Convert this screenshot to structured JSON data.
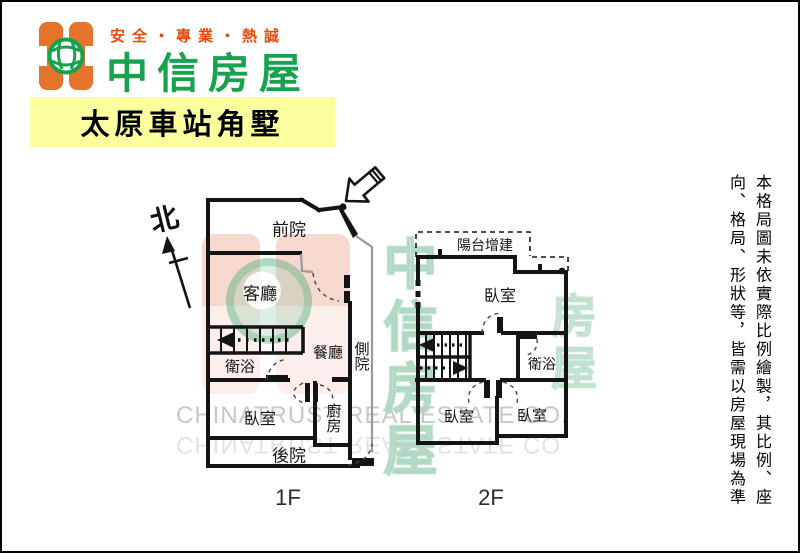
{
  "header": {
    "slogan": "安全・專業・熱誠",
    "brand": "中信房屋",
    "listing_title": "太原車站角墅",
    "colors": {
      "brand_orange": "#e5732a",
      "brand_green": "#17a24e",
      "slogan_red": "#e84a10",
      "banner_yellow": "#fbff9e"
    }
  },
  "floorplan": {
    "north_label": "北",
    "floor1": {
      "floor_label": "1F",
      "rooms": {
        "front_yard": "前院",
        "living_room": "客廳",
        "dining_room": "餐廳",
        "side_yard": "側院",
        "bathroom": "衛浴",
        "bedroom": "臥室",
        "kitchen": "廚房",
        "back_yard": "後院"
      }
    },
    "floor2": {
      "floor_label": "2F",
      "rooms": {
        "balcony_addition": "陽台增建",
        "bedroom_top": "臥室",
        "bathroom": "衛浴",
        "bedroom_bottom_left": "臥室",
        "bedroom_bottom_right": "臥室"
      }
    }
  },
  "watermark": {
    "latin_line": "CHINATRUST REAL ESTATE CO.",
    "cjk_column_main": "中信房屋",
    "cjk_column_secondary": "房屋"
  },
  "disclaimer": {
    "column_1": "本格局圖未依實際比例繪製，其比例、座",
    "column_2": "向、格局、形狀等，皆需以房屋現場為準"
  }
}
